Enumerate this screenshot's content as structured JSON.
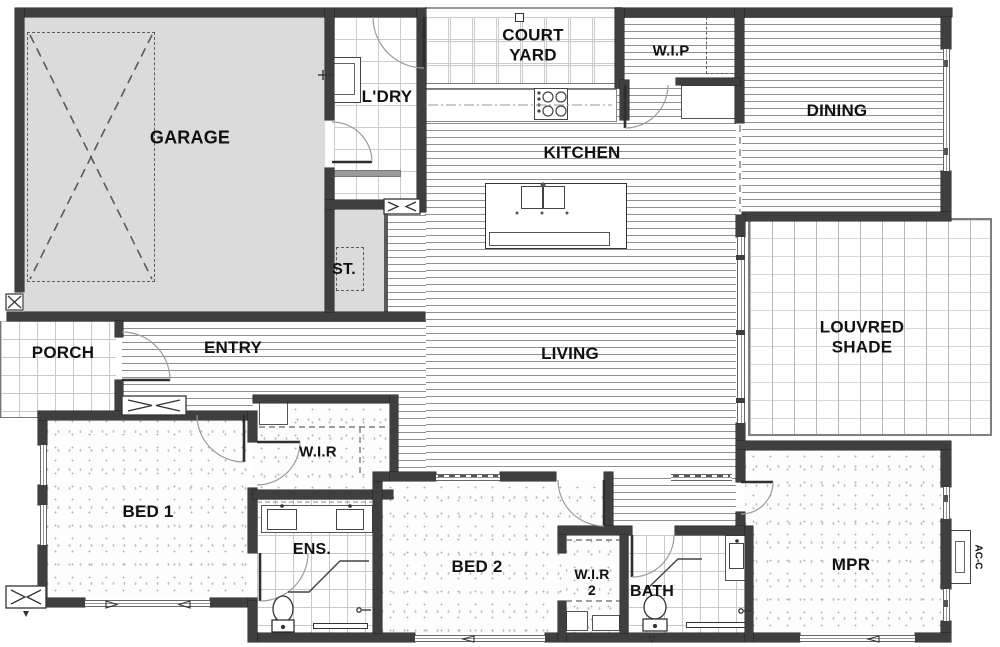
{
  "plan_type": "residential-floor-plan",
  "colors": {
    "wall": "#3f3f3f",
    "garage_fill": "#dbdbdb",
    "floorboard_line": "#8f8f8f",
    "tile_line": "#cccccc",
    "carpet_dot": "#b3b3b3",
    "label_text": "#111111"
  },
  "rooms": {
    "garage": {
      "label": "GARAGE"
    },
    "ldry": {
      "label": "L'DRY"
    },
    "courtyard": {
      "label": "COURT\nYARD"
    },
    "wip": {
      "label": "W.I.P"
    },
    "dining": {
      "label": "DINING"
    },
    "kitchen": {
      "label": "KITCHEN"
    },
    "st": {
      "label": "ST."
    },
    "porch": {
      "label": "PORCH"
    },
    "entry": {
      "label": "ENTRY"
    },
    "living": {
      "label": "LIVING"
    },
    "louvred_shade": {
      "label": "LOUVRED SHADE"
    },
    "wir1": {
      "label": "W.I.R"
    },
    "bed1": {
      "label": "BED 1"
    },
    "ens": {
      "label": "ENS."
    },
    "bed2": {
      "label": "BED 2"
    },
    "wir2": {
      "label": "W.I.R\n2"
    },
    "bath": {
      "label": "BATH"
    },
    "mpr": {
      "label": "MPR"
    }
  },
  "equipment": {
    "ac": {
      "label": "AC-C"
    }
  }
}
